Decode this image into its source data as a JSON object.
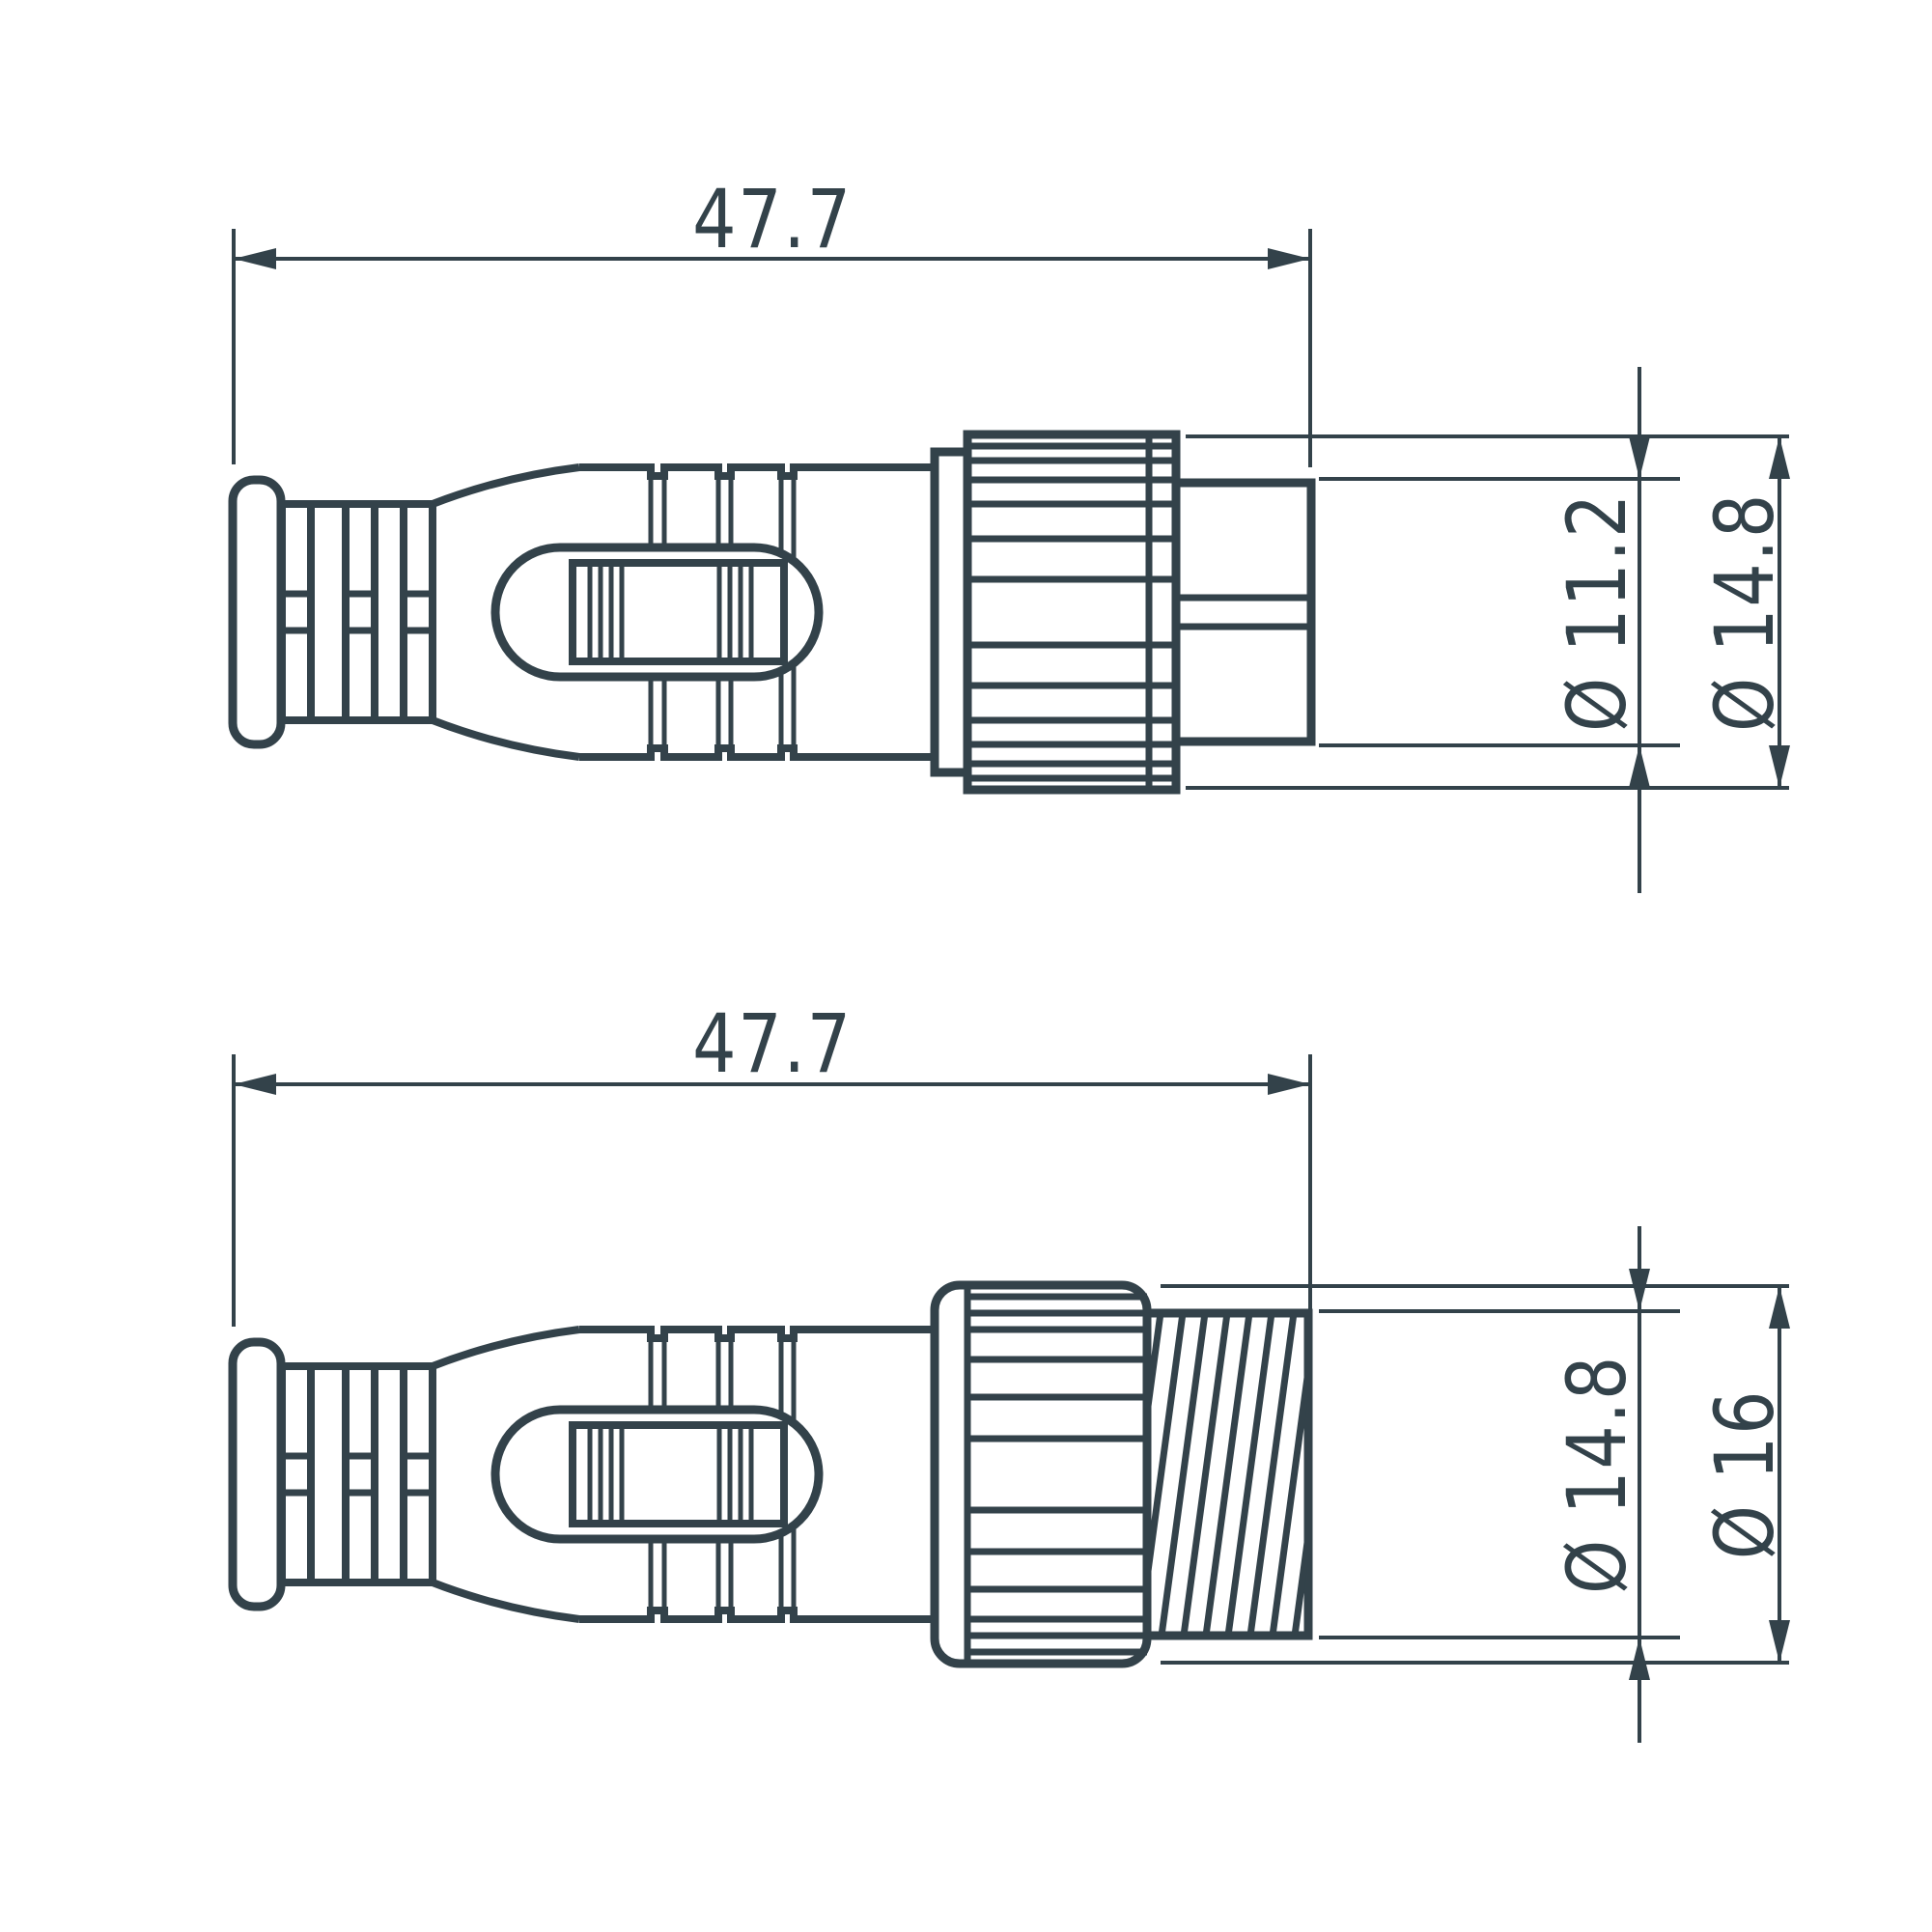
{
  "drawing": {
    "background_color": "#ffffff",
    "line_color": "#33424A",
    "views": {
      "top": {
        "length_label": "47.7",
        "tip_diameter_label": "Ø 11.2",
        "body_diameter_label": "Ø 14.8"
      },
      "bottom": {
        "length_label": "47.7",
        "thread_diameter_label": "Ø 14.8",
        "nut_diameter_label": "Ø 16"
      }
    },
    "dimensions_mm": {
      "length": 47.7,
      "tip_diameter": 11.2,
      "body_diameter": 14.8,
      "thread_diameter": 14.8,
      "nut_diameter": 16
    }
  }
}
